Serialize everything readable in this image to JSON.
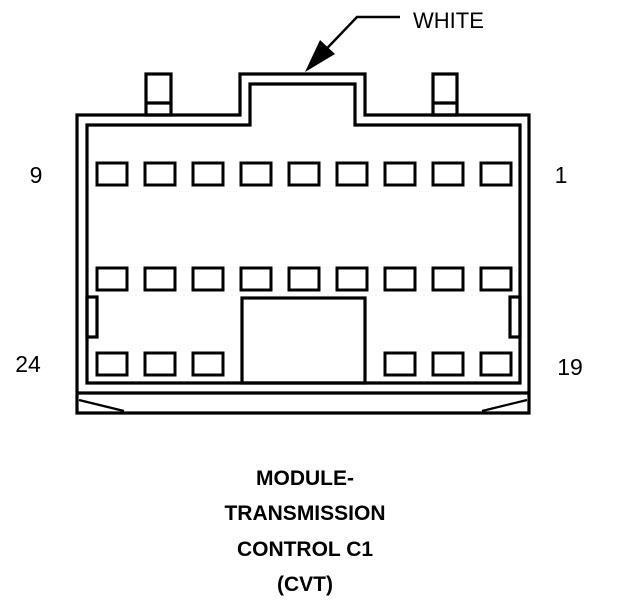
{
  "diagram": {
    "type": "connector-pinout",
    "background_color": "#ffffff",
    "line_color": "#000000"
  },
  "callout": {
    "label": "WHITE"
  },
  "pin_labels": {
    "top_left": "9",
    "top_right": "1",
    "bottom_left": "24",
    "bottom_right": "19"
  },
  "caption": {
    "lines": [
      "MODULE-",
      "TRANSMISSION",
      "CONTROL C1",
      "(CVT)"
    ]
  },
  "connector": {
    "total_pins": 24,
    "pin_width": 30,
    "pin_height": 22,
    "pin_rows": [
      {
        "name": "row-pins-1-to-9",
        "y": 163,
        "xs": [
          97,
          145,
          193,
          241,
          289,
          337,
          385,
          433,
          481
        ]
      },
      {
        "name": "row-pins-10-to-18",
        "y": 268,
        "xs": [
          97,
          145,
          193,
          241,
          289,
          337,
          385,
          433,
          481
        ]
      },
      {
        "name": "row-pins-19-to-24",
        "y": 353,
        "xs": [
          97,
          145,
          193,
          385,
          433,
          481
        ]
      }
    ]
  }
}
